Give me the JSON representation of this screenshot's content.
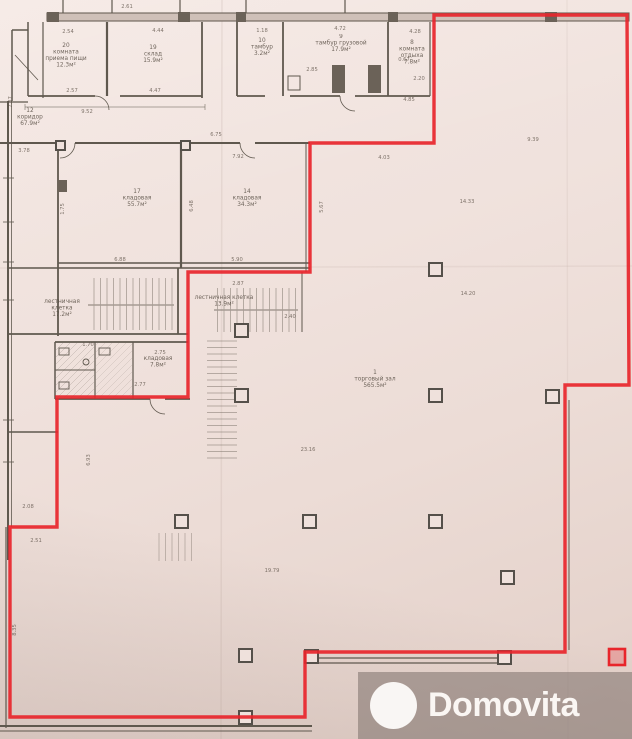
{
  "watermark": {
    "brand": "Domovita"
  },
  "colors": {
    "paper": "#f0e2dd",
    "ink": "#5f584e",
    "outline_red": "#e8252b",
    "watermark_band": "rgba(124,112,106,0.55)"
  },
  "rooms": [
    {
      "num": "20",
      "line1": "комната",
      "line2": "приема пищи",
      "area": "12.3м²"
    },
    {
      "num": "19",
      "line1": "склад",
      "line2": "",
      "area": "15.9м²"
    },
    {
      "num": "10",
      "line1": "тамбур",
      "line2": "",
      "area": "3.2м²"
    },
    {
      "num": "9",
      "line1": "тамбур грузовой",
      "line2": "",
      "area": "17.9м²"
    },
    {
      "num": "8",
      "line1": "комната",
      "line2": "отдыха",
      "area": "7.8м²"
    },
    {
      "num": "12",
      "line1": "коридор",
      "line2": "",
      "area": "67.9м²"
    },
    {
      "num": "17",
      "line1": "кладовая",
      "line2": "",
      "area": "55.7м²"
    },
    {
      "num": "14",
      "line1": "кладовая",
      "line2": "",
      "area": "34.3м²"
    },
    {
      "num": "",
      "line1": "лестничная",
      "line2": "клетка",
      "area": "17.2м²"
    },
    {
      "num": "",
      "line1": "лестничная клетка",
      "line2": "",
      "area": "13.9м²"
    },
    {
      "num": "",
      "line1": "кладовая",
      "line2": "",
      "area": "7.8м²"
    },
    {
      "num": "1",
      "line1": "торговый зал",
      "line2": "",
      "area": "565.5м²"
    }
  ],
  "dims": [
    {
      "v": "2.61"
    },
    {
      "v": "2.54"
    },
    {
      "v": "4.44"
    },
    {
      "v": "1.18"
    },
    {
      "v": "4.72"
    },
    {
      "v": "4.28"
    },
    {
      "v": "2.57"
    },
    {
      "v": "4.47"
    },
    {
      "v": "9.52"
    },
    {
      "v": "2.85"
    },
    {
      "v": "0.67"
    },
    {
      "v": "2.20"
    },
    {
      "v": "4.85"
    },
    {
      "v": "7.87"
    },
    {
      "v": "3.78"
    },
    {
      "v": "6.75"
    },
    {
      "v": "7.92"
    },
    {
      "v": "4.03"
    },
    {
      "v": "9.39"
    },
    {
      "v": "14.33"
    },
    {
      "v": "14.20"
    },
    {
      "v": "5.67"
    },
    {
      "v": "6.48"
    },
    {
      "v": "1.75"
    },
    {
      "v": "6.88"
    },
    {
      "v": "5.90"
    },
    {
      "v": "2.87"
    },
    {
      "v": "2.40"
    },
    {
      "v": "1.70"
    },
    {
      "v": "2.75"
    },
    {
      "v": "2.77"
    },
    {
      "v": "23.16"
    },
    {
      "v": "6.93"
    },
    {
      "v": "2.08"
    },
    {
      "v": "2.51"
    },
    {
      "v": "19.79"
    },
    {
      "v": "8.35"
    }
  ]
}
